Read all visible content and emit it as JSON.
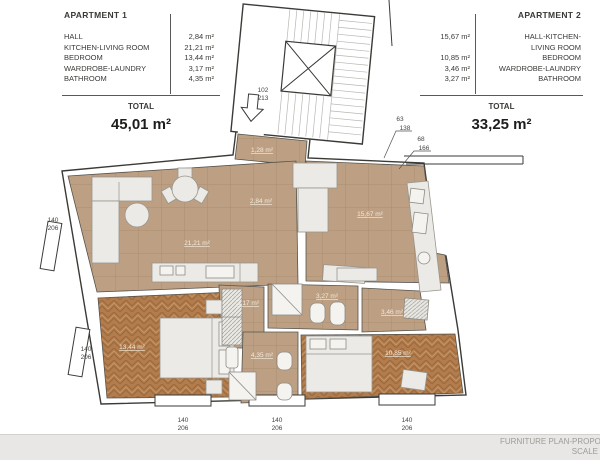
{
  "legend1": {
    "title": "APARTMENT 1",
    "rows": [
      {
        "label": "HALL",
        "value": "2,84 m²"
      },
      {
        "label": "KITCHEN-LIVING ROOM",
        "value": "21,21 m²"
      },
      {
        "label": "BEDROOM",
        "value": "13,44 m²"
      },
      {
        "label": "WARDROBE-LAUNDRY",
        "value": "3,17 m²"
      },
      {
        "label": "BATHROOM",
        "value": "4,35 m²"
      }
    ],
    "total_label": "TOTAL",
    "total_value": "45,01 m²"
  },
  "legend2": {
    "title": "APARTMENT 2",
    "rows": [
      {
        "value": "15,67 m²",
        "label": "HALL-KITCHEN-\nLIVING ROOM"
      },
      {
        "value": "10,85 m²",
        "label": "BEDROOM"
      },
      {
        "value": "3,46 m²",
        "label": "WARDROBE-LAUNDRY"
      },
      {
        "value": "3,27 m²",
        "label": "BATHROOM"
      }
    ],
    "total_label": "TOTAL",
    "total_value": "33,25 m²"
  },
  "plan": {
    "rooms": {
      "entry": "1,28 m²",
      "apt1_hall": "2,84 m²",
      "apt1_kitchen_living": "21,21 m²",
      "apt1_bedroom": "13,44 m²",
      "apt1_wardrobe": "3,17 m²",
      "apt1_bathroom": "4,35 m²",
      "apt2_living": "15,67 m²",
      "apt2_bedroom": "10,85 m²",
      "apt2_wardrobe": "3,46 m²",
      "apt2_bathroom": "3,27 m²"
    },
    "dims": {
      "entry_w": "102",
      "entry_h": "213",
      "d63": "63",
      "d138": "138",
      "d68": "68",
      "d166": "166",
      "w140": "140",
      "h206": "206"
    }
  },
  "footer": {
    "plan_title": "FURNITURE PLAN-PROPO",
    "scale_label": "SCALE"
  },
  "colors": {
    "tile": "#bda083",
    "wood": "#b27c4c",
    "outline": "#3b3a36"
  }
}
